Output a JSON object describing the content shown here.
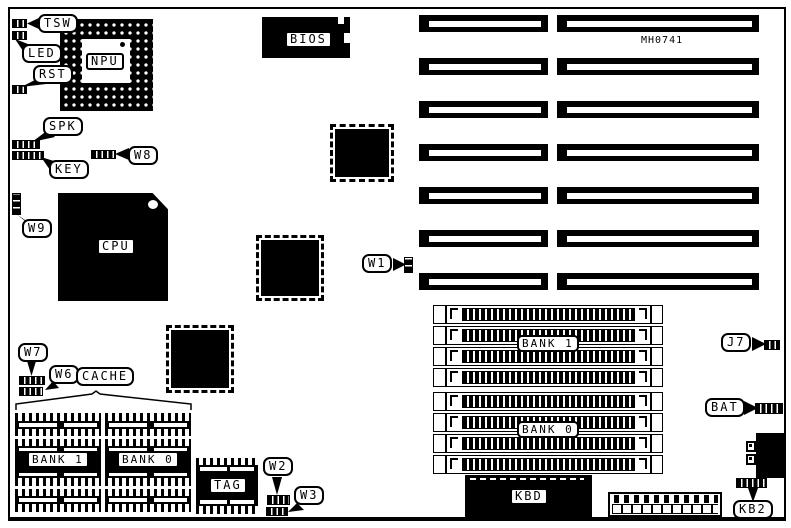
{
  "board": {
    "part_number": "MH0741",
    "callouts": {
      "tsw": "TSW",
      "led": "LED",
      "rst": "RST",
      "spk": "SPK",
      "key": "KEY",
      "w1": "W1",
      "w2": "W2",
      "w3": "W3",
      "w6": "W6",
      "w7": "W7",
      "w8": "W8",
      "w9": "W9",
      "cache": "CACHE",
      "j7": "J7",
      "bat": "BAT",
      "kb2": "KB2"
    },
    "chips": {
      "npu": "NPU",
      "cpu": "CPU",
      "bios": "BIOS",
      "kbd": "KBD",
      "tag": "TAG"
    },
    "memory": {
      "cache_bank1": "BANK 1",
      "cache_bank0": "BANK 0",
      "simm_bank1": "BANK 1",
      "simm_bank0": "BANK 0"
    },
    "colors": {
      "ink": "#000000",
      "paper": "#ffffff"
    }
  }
}
